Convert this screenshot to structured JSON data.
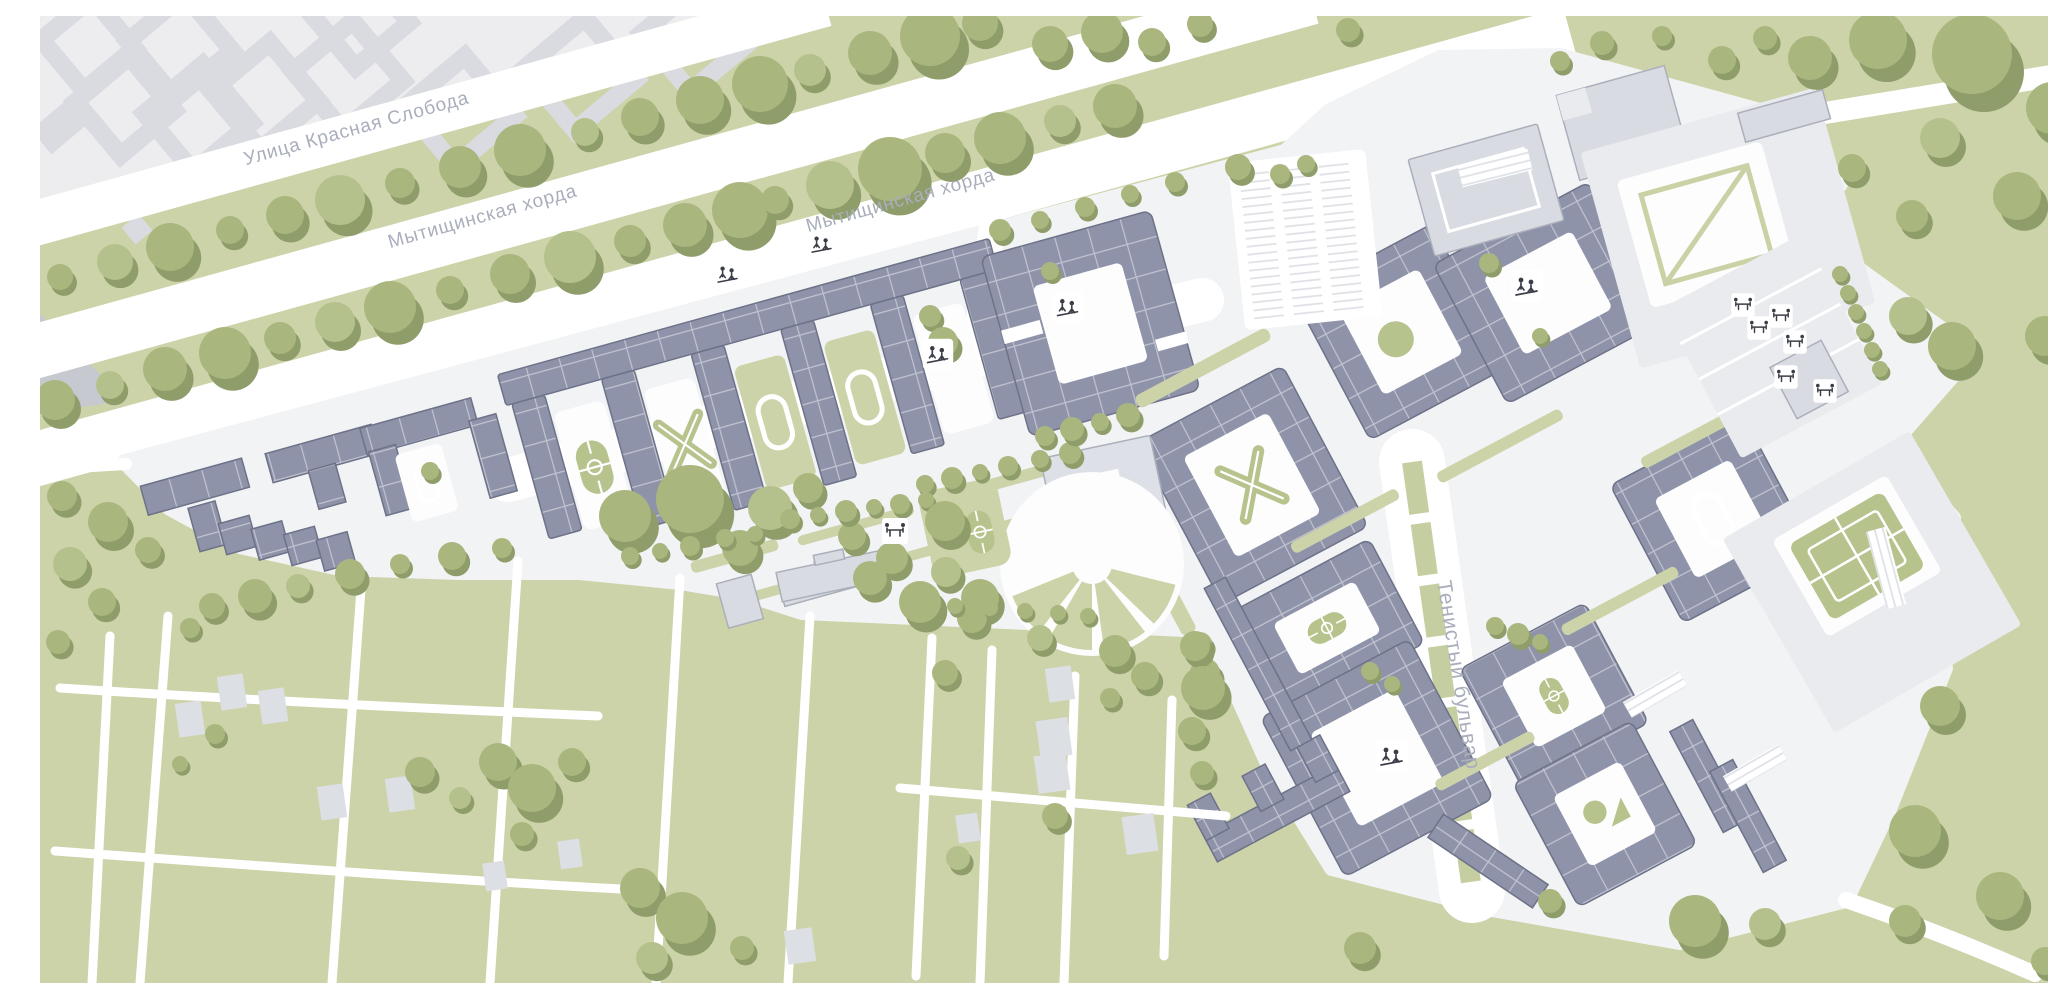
{
  "meta": {
    "type": "master-plan-map",
    "description": "Architectural master plan of a residential district with courtyard blocks, boulevards and green areas"
  },
  "map": {
    "streets": [
      {
        "id": "ulitsa-krasnaya-sloboda",
        "label": "Улица Красная Слобода"
      },
      {
        "id": "mytishchinskaya-khorda-west",
        "label": "Мытищинская хорда"
      },
      {
        "id": "mytishchinskaya-khorda-east",
        "label": "Мытищинская хорда"
      },
      {
        "id": "tenistyy-bulvar",
        "label": "Тенистый бульвар"
      }
    ],
    "icons": [
      {
        "name": "tree-icon",
        "meaning": "tree / greenery"
      },
      {
        "name": "playground-icon",
        "meaning": "children playground in courtyard"
      },
      {
        "name": "picnic-table-icon",
        "meaning": "outdoor tables / seating area"
      },
      {
        "name": "sports-field-icon",
        "meaning": "sports field / running track"
      },
      {
        "name": "parking-icon",
        "meaning": "surface parking rows"
      }
    ]
  },
  "theme": {
    "bg": "#ccd3a9",
    "road": "#ffffff",
    "platform": "#f2f3f5",
    "court": "#fdfdfe",
    "slate": "#8e93a9",
    "slateLine": "#6d7288",
    "pale": "#d8dbe1",
    "paleLine": "#abafbb",
    "paleGround": "#e9ebee",
    "ctx": "#ededf0",
    "ctxBldg": "#d9dbe0",
    "ctxDark": "#c7c9d0",
    "tree": "#a9b67e",
    "treeLight": "#b5c18c",
    "treeShadow": "#8e9d6a",
    "oval": "#b7c38c",
    "label": "#a9aebc"
  }
}
